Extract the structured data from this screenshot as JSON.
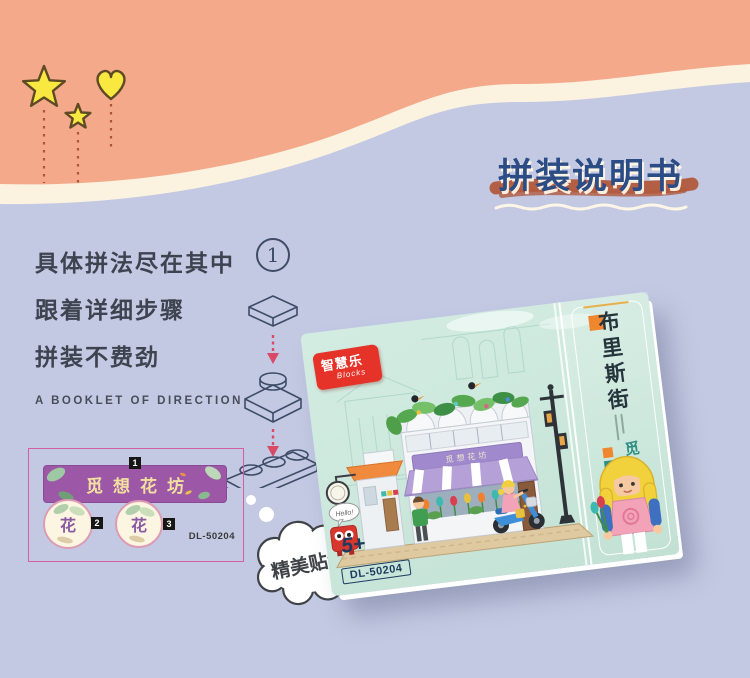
{
  "colors": {
    "background": "#c3c9e3",
    "hero_orange": "#f4a98a",
    "hero_cream": "#fbf2df",
    "shape_yellow": "#f9e83f",
    "shape_outline": "#5f4a26",
    "title_navy": "#2b4c85",
    "brush_red": "#b25a3d",
    "text_dark": "#3d434f",
    "line_art_navy": "#3e4c68",
    "arrow_red": "#d84a66",
    "sticker_border_pink": "#d25fa6",
    "banner_purple": "#9c58a6",
    "box_mint": "#cde8dd",
    "logo_red": "#e53329",
    "teal": "#2f8f85",
    "orange_accent": "#f0862e",
    "navy_box": "#1e3a5f"
  },
  "title": {
    "text": "拼装说明书"
  },
  "intro": {
    "lines": [
      "具体拼法尽在其中",
      "跟着详细步骤",
      "拼装不费劲"
    ],
    "caption": "A BOOKLET OF DIRECTION"
  },
  "steps": {
    "number": "1"
  },
  "sticker_sheet": {
    "banner": "觅想花坊",
    "tag1": "1",
    "tag2": "2",
    "tag3": "3",
    "flower_char": "花",
    "code": "DL-50204"
  },
  "bubble": {
    "text": "精美贴纸"
  },
  "box": {
    "logo_name": "智慧乐",
    "logo_sub": "Blocks",
    "series_title": "布里斯街",
    "product_name": "觅想花坊",
    "storefront_sign": "觅想花坊",
    "robot_speech": "Hello!",
    "age": "5+",
    "model_code": "DL-50204"
  }
}
